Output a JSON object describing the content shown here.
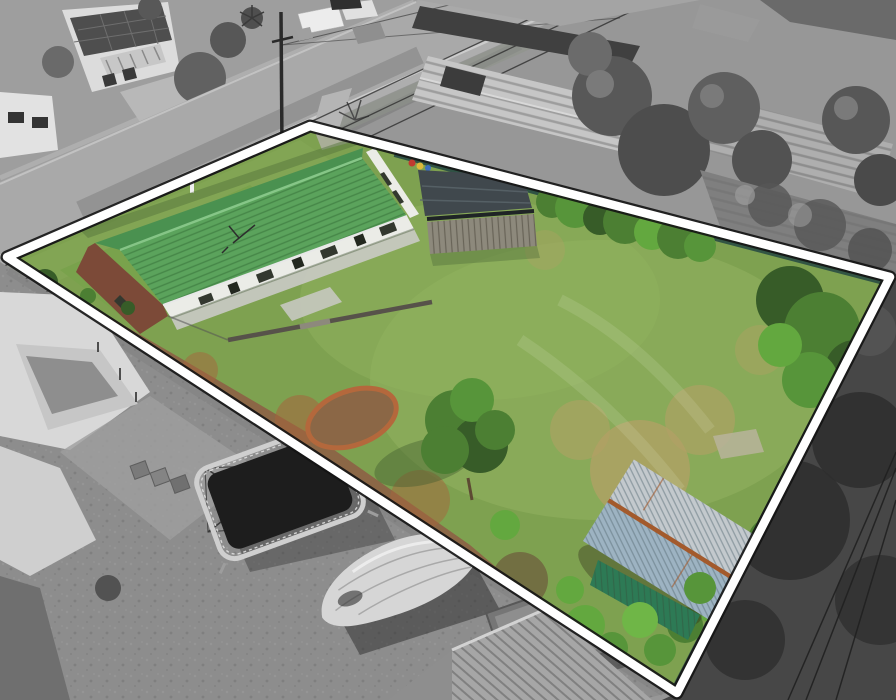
{
  "palette": {
    "boundary_white": "#ffffff",
    "boundary_shadow": "#141414",
    "lawn": "#7ea150",
    "lawn_light": "#90b05e",
    "lawn_dry": "#b3a065",
    "dirt": "#8b6746",
    "dirt_red": "#a5653c",
    "tree_dark": "#375c28",
    "tree_mid": "#4c7f33",
    "tree_bright": "#63a83f",
    "hedge": "#57953a",
    "roof_green": "#5ba35c",
    "roof_green_dark": "#4a9150",
    "wall_white": "#ebece7",
    "brick": "#7c4a38",
    "window_dark": "#33382f",
    "path_concrete": "#c6c8c0",
    "carport_roof": "#40484d",
    "timber": "#8d897c",
    "fence_green": "#2f5244",
    "shed_wall": "#2d7a55",
    "shed_roof": "#c3c9cd",
    "shed_roof_blue": "#9db3c2",
    "rust": "#a35a2c",
    "gray_base": "#979797",
    "road": "#a9a9a9",
    "gray_roof_light": "#c6c6c6",
    "gray_roof_mid": "#aeaeae",
    "asphalt": "#474747",
    "yard_gray": "#8d8d8d",
    "tarp": "#d6d6d6",
    "tramp_mat": "#1d1d1d",
    "toy_red": "#c03a30",
    "toy_yellow": "#ddb93a"
  },
  "scene": {
    "kind": "aerial-property-photo",
    "highlight": "colored-lot-inside-white-outline-over-grayscale-neighborhood",
    "elements": [
      "street",
      "footpath",
      "power-pole",
      "power-lines",
      "neighbor-houses",
      "neighbor-roofs",
      "property-boundary",
      "front-lawn",
      "back-lawn",
      "house-green-roof",
      "brick-gable",
      "carport",
      "timber-fence",
      "green-fence",
      "garden-shed",
      "garden-ring",
      "center-tree",
      "hedge-row",
      "dirt-strip",
      "paving-slab",
      "trampoline",
      "covered-boat",
      "box-trailer",
      "clothesline",
      "wheelie-bins",
      "driveway-shadows"
    ]
  }
}
